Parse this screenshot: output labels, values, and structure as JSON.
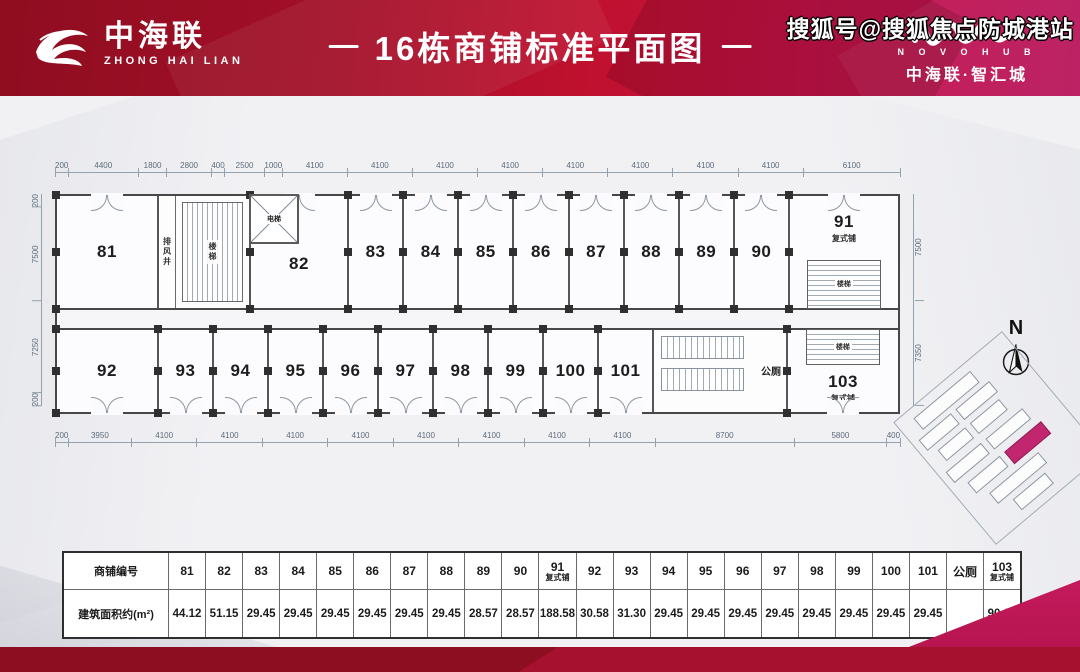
{
  "header": {
    "logo_cn": "中海联",
    "logo_en": "ZHONG HAI LIAN",
    "title": "16栋商铺标准平面图",
    "brand_logo": "N O V O H U B",
    "brand_name": "中海联·智汇城",
    "watermark": "搜狐号@搜狐焦点防城港站"
  },
  "plan": {
    "north_label": "N",
    "top_dims": [
      "200",
      "4400",
      "1800",
      "2800",
      "400",
      "2500",
      "1000",
      "4100",
      "4100",
      "4100",
      "4100",
      "4100",
      "4100",
      "4100",
      "4100",
      "6100"
    ],
    "bottom_dims": [
      "200",
      "3950",
      "4100",
      "4100",
      "4100",
      "4100",
      "4100",
      "4100",
      "4100",
      "4100",
      "8700",
      "5800",
      "400"
    ],
    "left_dims": [
      "200",
      "7500",
      "7250",
      "200"
    ],
    "right_dims": [
      "7500",
      "7350"
    ],
    "utility": {
      "exhaust": "排风井",
      "stairs": "楼梯",
      "elevator": "电梯"
    },
    "shop_81": {
      "id": "81"
    },
    "shop_82": {
      "id": "82"
    },
    "shops_top": [
      "83",
      "84",
      "85",
      "86",
      "87",
      "88",
      "89",
      "90"
    ],
    "shop_91": {
      "id": "91",
      "sub": "复式铺",
      "stairs": "楼梯"
    },
    "shop_92": {
      "id": "92"
    },
    "shops_bottom": [
      "93",
      "94",
      "95",
      "96",
      "97",
      "98",
      "99",
      "100",
      "101"
    ],
    "toilet": {
      "label": "公厕"
    },
    "shop_103": {
      "id": "103",
      "sub": "复式铺",
      "stairs": "楼梯"
    }
  },
  "table": {
    "row_label_id": "商铺编号",
    "row_label_area": "建筑面积约(m²)",
    "columns": [
      {
        "id": "81",
        "sub": "",
        "area": "44.12"
      },
      {
        "id": "82",
        "sub": "",
        "area": "51.15"
      },
      {
        "id": "83",
        "sub": "",
        "area": "29.45"
      },
      {
        "id": "84",
        "sub": "",
        "area": "29.45"
      },
      {
        "id": "85",
        "sub": "",
        "area": "29.45"
      },
      {
        "id": "86",
        "sub": "",
        "area": "29.45"
      },
      {
        "id": "87",
        "sub": "",
        "area": "29.45"
      },
      {
        "id": "88",
        "sub": "",
        "area": "29.45"
      },
      {
        "id": "89",
        "sub": "",
        "area": "28.57"
      },
      {
        "id": "90",
        "sub": "",
        "area": "28.57"
      },
      {
        "id": "91",
        "sub": "复式铺",
        "area": "188.58"
      },
      {
        "id": "92",
        "sub": "",
        "area": "30.58"
      },
      {
        "id": "93",
        "sub": "",
        "area": "31.30"
      },
      {
        "id": "94",
        "sub": "",
        "area": "29.45"
      },
      {
        "id": "95",
        "sub": "",
        "area": "29.45"
      },
      {
        "id": "96",
        "sub": "",
        "area": "29.45"
      },
      {
        "id": "97",
        "sub": "",
        "area": "29.45"
      },
      {
        "id": "98",
        "sub": "",
        "area": "29.45"
      },
      {
        "id": "99",
        "sub": "",
        "area": "29.45"
      },
      {
        "id": "100",
        "sub": "",
        "area": "29.45"
      },
      {
        "id": "101",
        "sub": "",
        "area": "29.45"
      },
      {
        "id": "公厕",
        "sub": "",
        "area": ""
      },
      {
        "id": "103",
        "sub": "复式铺",
        "area": "90.18"
      }
    ]
  },
  "colors": {
    "brand_red": "#a30f28",
    "brand_magenta": "#c01a5a",
    "highlighted_building": "#c2266e"
  }
}
